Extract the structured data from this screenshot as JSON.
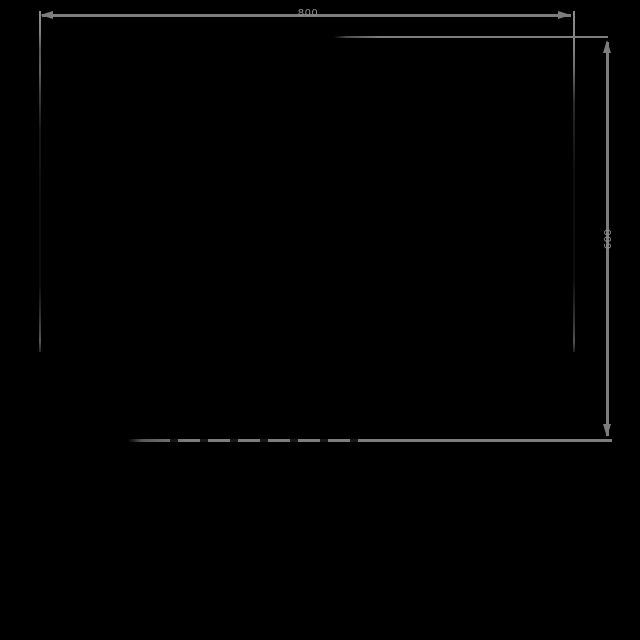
{
  "diagram": {
    "type": "technical-dimension-drawing",
    "background_color": "#000000",
    "line_color": "#7d7d7d",
    "label_color": "#8f8f8f",
    "dimensions": {
      "width": {
        "label": "800"
      },
      "height": {
        "label": "600"
      }
    }
  }
}
